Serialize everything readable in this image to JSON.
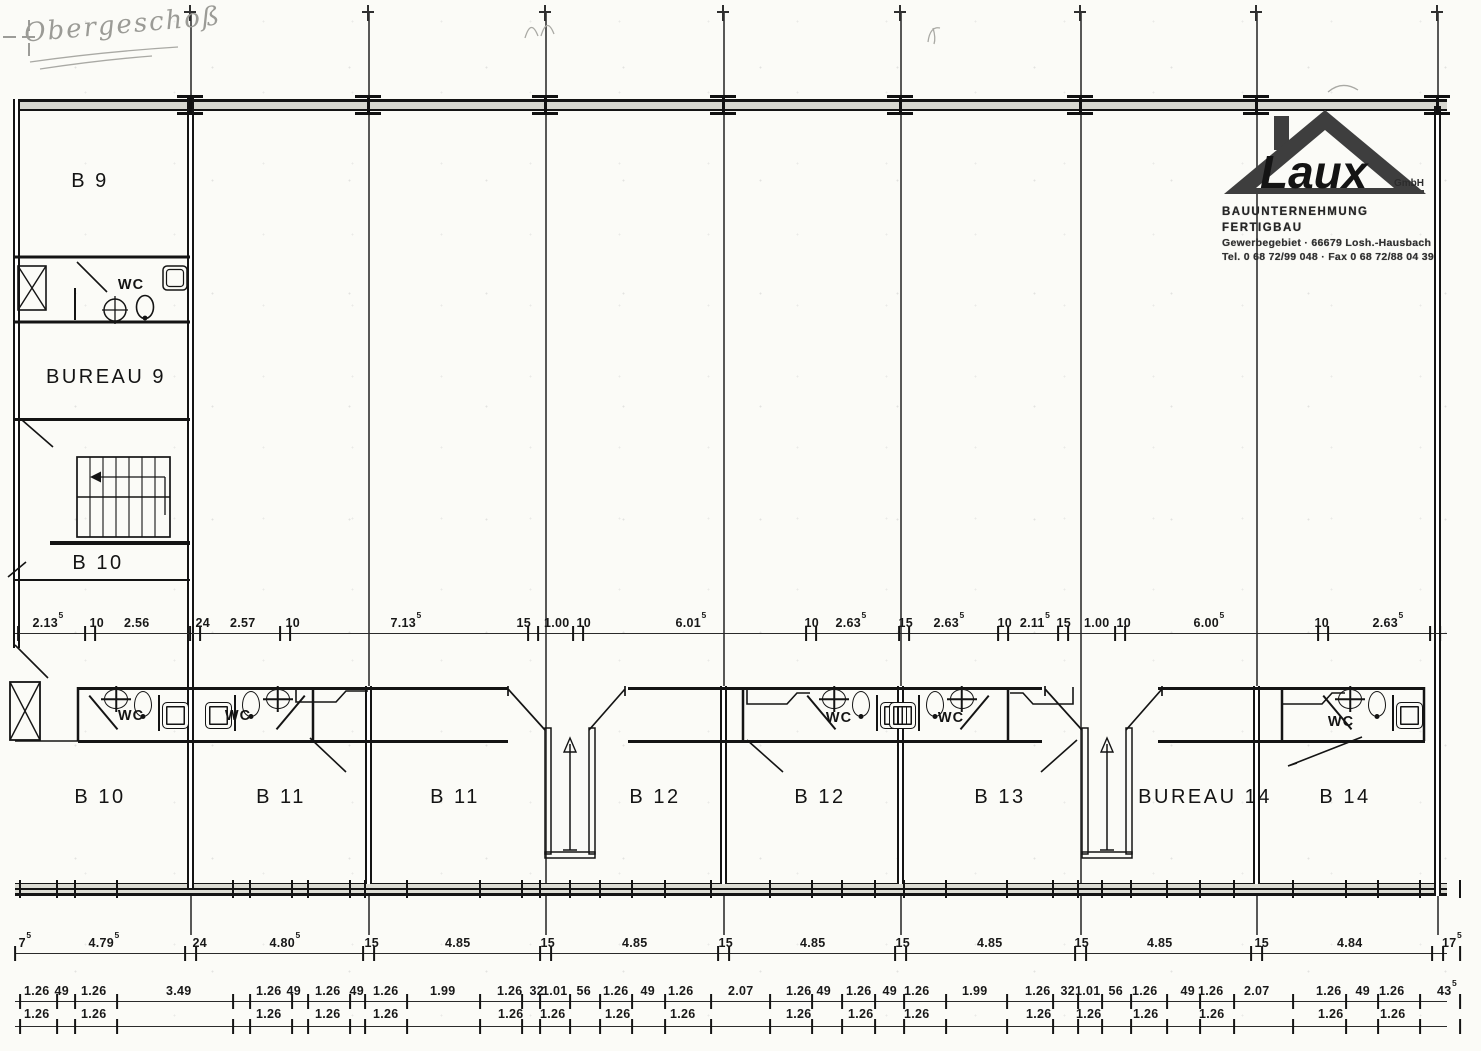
{
  "note": {
    "text": "Obergeschoß"
  },
  "logo": {
    "brand": "Laux",
    "suffix": "GmbH",
    "line1": "BAUUNTERNEHMUNG FERTIGBAU",
    "line2": "Gewerbegebiet · 66679 Losh.-Hausbach",
    "line3": "Tel. 0 68 72/99 048 · Fax 0 68 72/88 04 39"
  },
  "rooms": [
    {
      "label": "B 9",
      "x": 90,
      "y": 170
    },
    {
      "label": "BUREAU 9",
      "x": 106,
      "y": 366
    },
    {
      "label": "B 10",
      "x": 98,
      "y": 552
    },
    {
      "label": "B 10",
      "x": 100,
      "y": 786
    },
    {
      "label": "B 11",
      "x": 281,
      "y": 786
    },
    {
      "label": "B 11",
      "x": 455,
      "y": 786
    },
    {
      "label": "B 12",
      "x": 655,
      "y": 786
    },
    {
      "label": "B 12",
      "x": 820,
      "y": 786
    },
    {
      "label": "B 13",
      "x": 1000,
      "y": 786
    },
    {
      "label": "BUREAU 14",
      "x": 1205,
      "y": 786
    },
    {
      "label": "B 14",
      "x": 1345,
      "y": 786
    }
  ],
  "wc_labels": [
    {
      "label": "WC",
      "x": 131,
      "y": 277
    },
    {
      "label": "WC",
      "x": 131,
      "y": 708
    },
    {
      "label": "WC",
      "x": 238,
      "y": 708
    },
    {
      "label": "WC",
      "x": 839,
      "y": 710
    },
    {
      "label": "WC",
      "x": 951,
      "y": 710
    },
    {
      "label": "WC",
      "x": 1341,
      "y": 714
    }
  ],
  "grid": {
    "lines": [
      {
        "x": 190
      },
      {
        "x": 368
      },
      {
        "x": 545
      },
      {
        "x": 723
      },
      {
        "x": 900
      },
      {
        "x": 1080
      },
      {
        "x": 1256
      },
      {
        "x": 1437
      }
    ],
    "columns": [
      {
        "x": 190
      },
      {
        "x": 368
      },
      {
        "x": 545
      },
      {
        "x": 723
      },
      {
        "x": 900
      },
      {
        "x": 1080
      },
      {
        "x": 1256
      },
      {
        "x": 1437
      }
    ],
    "top_ticks": [
      {
        "x": 190
      },
      {
        "x": 368
      },
      {
        "x": 545
      },
      {
        "x": 723
      },
      {
        "x": 900
      },
      {
        "x": 1080
      },
      {
        "x": 1256
      },
      {
        "x": 1437
      }
    ]
  },
  "wc_units": [
    {
      "x": 82
    },
    {
      "x": 200,
      "cls": "flip"
    },
    {
      "x": 800
    },
    {
      "x": 884,
      "cls": "flip"
    },
    {
      "x": 1316
    }
  ],
  "vestibules": [
    {
      "x": 475
    },
    {
      "x": 1012
    }
  ],
  "dims": {
    "mid": {
      "labels": [
        {
          "v": "2.13",
          "s": "5",
          "x": 48
        },
        {
          "v": "10",
          "x": 97
        },
        {
          "v": "2.56",
          "x": 137
        },
        {
          "v": "24",
          "x": 203
        },
        {
          "v": "2.57",
          "x": 243
        },
        {
          "v": "10",
          "x": 293
        },
        {
          "v": "7.13",
          "s": "5",
          "x": 406
        },
        {
          "v": "15",
          "x": 524
        },
        {
          "v": "1.00",
          "x": 557
        },
        {
          "v": "10",
          "x": 584
        },
        {
          "v": "6.01",
          "s": "5",
          "x": 691
        },
        {
          "v": "10",
          "x": 812
        },
        {
          "v": "2.63",
          "s": "5",
          "x": 851
        },
        {
          "v": "15",
          "x": 906
        },
        {
          "v": "2.63",
          "s": "5",
          "x": 949
        },
        {
          "v": "10",
          "x": 1005
        },
        {
          "v": "2.11",
          "s": "5",
          "x": 1035
        },
        {
          "v": "15",
          "x": 1064
        },
        {
          "v": "1.00",
          "x": 1097
        },
        {
          "v": "10",
          "x": 1124
        },
        {
          "v": "6.00",
          "s": "5",
          "x": 1209
        },
        {
          "v": "10",
          "x": 1322
        },
        {
          "v": "2.63",
          "s": "5",
          "x": 1388
        }
      ],
      "ticks": [
        {
          "x": 18
        },
        {
          "x": 85
        },
        {
          "x": 95
        },
        {
          "x": 190
        },
        {
          "x": 200
        },
        {
          "x": 280
        },
        {
          "x": 290
        },
        {
          "x": 528
        },
        {
          "x": 538
        },
        {
          "x": 573
        },
        {
          "x": 583
        },
        {
          "x": 806
        },
        {
          "x": 816
        },
        {
          "x": 899
        },
        {
          "x": 909
        },
        {
          "x": 998
        },
        {
          "x": 1008
        },
        {
          "x": 1058
        },
        {
          "x": 1068
        },
        {
          "x": 1115
        },
        {
          "x": 1125
        },
        {
          "x": 1318
        },
        {
          "x": 1328
        },
        {
          "x": 1430
        },
        {
          "x": 1440
        }
      ]
    },
    "row1": {
      "labels": [
        {
          "v": "7",
          "s": "5",
          "x": 25
        },
        {
          "v": "4.79",
          "s": "5",
          "x": 104
        },
        {
          "v": "24",
          "x": 200
        },
        {
          "v": "4.80",
          "s": "5",
          "x": 285
        },
        {
          "v": "15",
          "x": 372
        },
        {
          "v": "4.85",
          "x": 458
        },
        {
          "v": "15",
          "x": 548
        },
        {
          "v": "4.85",
          "x": 635
        },
        {
          "v": "15",
          "x": 726
        },
        {
          "v": "4.85",
          "x": 813
        },
        {
          "v": "15",
          "x": 903
        },
        {
          "v": "4.85",
          "x": 990
        },
        {
          "v": "15",
          "x": 1082
        },
        {
          "v": "4.85",
          "x": 1160
        },
        {
          "v": "15",
          "x": 1262
        },
        {
          "v": "4.84",
          "x": 1350
        },
        {
          "v": "17",
          "s": "5",
          "x": 1452
        }
      ],
      "ticks": [
        {
          "x": 15
        },
        {
          "x": 185
        },
        {
          "x": 196
        },
        {
          "x": 363
        },
        {
          "x": 374
        },
        {
          "x": 540
        },
        {
          "x": 551
        },
        {
          "x": 718
        },
        {
          "x": 729
        },
        {
          "x": 895
        },
        {
          "x": 906
        },
        {
          "x": 1075
        },
        {
          "x": 1086
        },
        {
          "x": 1251
        },
        {
          "x": 1262
        },
        {
          "x": 1432
        },
        {
          "x": 1443
        },
        {
          "x": 1460
        }
      ]
    },
    "chain_upper": {
      "labels": [
        {
          "v": "1.26",
          "x": 37
        },
        {
          "v": "49",
          "x": 62
        },
        {
          "v": "1.26",
          "x": 94
        },
        {
          "v": "3.49",
          "x": 179
        },
        {
          "v": "1.26",
          "x": 269
        },
        {
          "v": "49",
          "x": 294
        },
        {
          "v": "1.26",
          "x": 328
        },
        {
          "v": "49",
          "x": 357
        },
        {
          "v": "1.26",
          "x": 386
        },
        {
          "v": "1.99",
          "x": 443
        },
        {
          "v": "1.26",
          "x": 510
        },
        {
          "v": "32",
          "x": 537
        },
        {
          "v": "1.01",
          "x": 555
        },
        {
          "v": "56",
          "x": 584
        },
        {
          "v": "1.26",
          "x": 616
        },
        {
          "v": "49",
          "x": 648
        },
        {
          "v": "1.26",
          "x": 681
        },
        {
          "v": "2.07",
          "x": 741
        },
        {
          "v": "1.26",
          "x": 799
        },
        {
          "v": "49",
          "x": 824
        },
        {
          "v": "1.26",
          "x": 859
        },
        {
          "v": "49",
          "x": 890
        },
        {
          "v": "1.26",
          "x": 917
        },
        {
          "v": "1.99",
          "x": 975
        },
        {
          "v": "1.26",
          "x": 1038
        },
        {
          "v": "32",
          "x": 1068
        },
        {
          "v": "1.01",
          "x": 1088
        },
        {
          "v": "56",
          "x": 1116
        },
        {
          "v": "1.26",
          "x": 1145
        },
        {
          "v": "49",
          "x": 1188
        },
        {
          "v": "1.26",
          "x": 1211
        },
        {
          "v": "2.07",
          "x": 1257
        },
        {
          "v": "1.26",
          "x": 1329
        },
        {
          "v": "49",
          "x": 1363
        },
        {
          "v": "1.26",
          "x": 1392
        },
        {
          "v": "43",
          "s": "5",
          "x": 1447
        }
      ],
      "ticks": [
        {
          "x": 20
        },
        {
          "x": 57
        },
        {
          "x": 75
        },
        {
          "x": 117
        },
        {
          "x": 233
        },
        {
          "x": 250
        },
        {
          "x": 292
        },
        {
          "x": 308
        },
        {
          "x": 350
        },
        {
          "x": 365
        },
        {
          "x": 407
        },
        {
          "x": 480
        },
        {
          "x": 522
        },
        {
          "x": 540
        },
        {
          "x": 570
        },
        {
          "x": 600
        },
        {
          "x": 632
        },
        {
          "x": 665
        },
        {
          "x": 711
        },
        {
          "x": 770
        },
        {
          "x": 812
        },
        {
          "x": 842
        },
        {
          "x": 875
        },
        {
          "x": 904
        },
        {
          "x": 946
        },
        {
          "x": 1007
        },
        {
          "x": 1053
        },
        {
          "x": 1078
        },
        {
          "x": 1102
        },
        {
          "x": 1131
        },
        {
          "x": 1167
        },
        {
          "x": 1200
        },
        {
          "x": 1234
        },
        {
          "x": 1293
        },
        {
          "x": 1346
        },
        {
          "x": 1378
        },
        {
          "x": 1420
        },
        {
          "x": 1460
        }
      ]
    },
    "chain_lower": {
      "labels": [
        {
          "v": "1.26",
          "x": 37
        },
        {
          "v": "1.26",
          "x": 94
        },
        {
          "v": "1.26",
          "x": 269
        },
        {
          "v": "1.26",
          "x": 328
        },
        {
          "v": "1.26",
          "x": 386
        },
        {
          "v": "1.26",
          "x": 511
        },
        {
          "v": "1.26",
          "x": 553
        },
        {
          "v": "1.26",
          "x": 618
        },
        {
          "v": "1.26",
          "x": 683
        },
        {
          "v": "1.26",
          "x": 799
        },
        {
          "v": "1.26",
          "x": 861
        },
        {
          "v": "1.26",
          "x": 917
        },
        {
          "v": "1.26",
          "x": 1039
        },
        {
          "v": "1.26",
          "x": 1089
        },
        {
          "v": "1.26",
          "x": 1146
        },
        {
          "v": "1.26",
          "x": 1212
        },
        {
          "v": "1.26",
          "x": 1331
        },
        {
          "v": "1.26",
          "x": 1393
        }
      ]
    }
  },
  "colors": {
    "ink": "#161616",
    "paper": "#fbfbf7",
    "wall_fill": "#d7d7d0",
    "handwriting": "#9b9b96"
  }
}
